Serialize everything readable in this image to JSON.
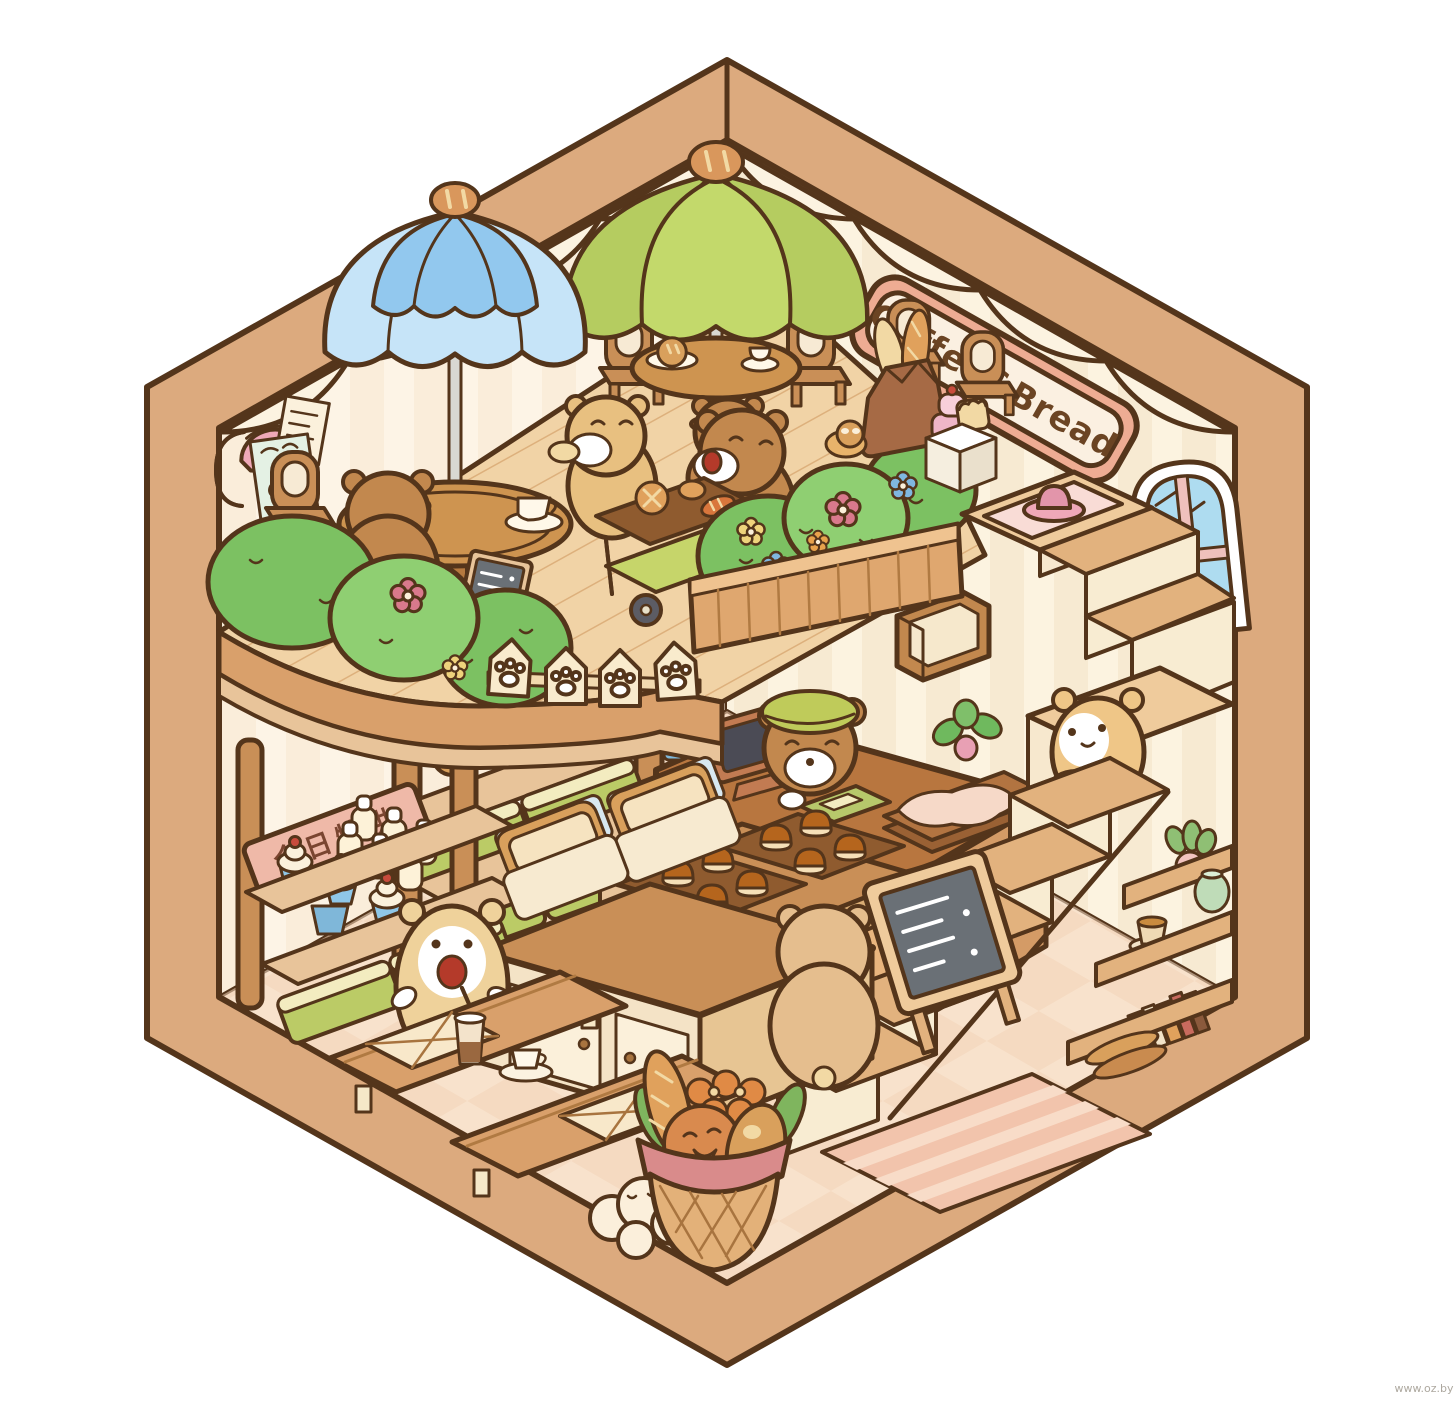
{
  "artwork": {
    "sign_coffee_bread": "Coffee&Bread",
    "sign_monthly_special": "今日特供",
    "watermark": "www.oz.by"
  },
  "palette": {
    "outline": "#54351B",
    "frame": "#DCAA7E",
    "wall": "#F8ECD6",
    "wall_left": "#FAEDDA",
    "floor": "#F8E2CC",
    "deck": "#F1D3A6",
    "wood": "#C98F57",
    "wood_dark": "#8F5B2F",
    "umbrella_blue": "#92C8EE",
    "umbrella_blue_light": "#C6E4F8",
    "umbrella_green": "#C3D96B",
    "umbrella_green_light": "#EDEFCB",
    "bush_green": "#7CC162",
    "bush_green_light": "#8FCF72",
    "bear_brown": "#C2884E",
    "bear_tan": "#E8C080",
    "bear_cream": "#EFD29B",
    "sign_pink": "#EEAC93",
    "sign_cream": "#FBF0E1",
    "board_pink": "#EFB9A8",
    "window_glass": "#AEDCF0",
    "window_pink": "#EFC0BC",
    "chalkboard": "#6A7076",
    "mouth_red": "#B43A2A"
  },
  "objects": [
    "coffee-bread-sign",
    "arched-window",
    "wall-lamp",
    "coffee-poster",
    "note-paper",
    "blue-umbrella",
    "green-umbrella",
    "cafe-tables",
    "cafe-chairs",
    "bear-eating-bread",
    "bear-back-view",
    "bear-with-cart",
    "bread-cart",
    "chalkboard-easel",
    "flower-bushes",
    "paw-fence",
    "flower-planter-box",
    "bread-bag",
    "pink-cake",
    "toast-cube",
    "mezzanine-deck",
    "staircase",
    "pink-rug-with-hat",
    "hamster-with-bread",
    "cashier-bear",
    "pos-tablet",
    "card-tray",
    "paper-trays",
    "potted-plants",
    "wall-cubby",
    "bread-racks",
    "green-bread-baskets",
    "monthly-special-sign",
    "milk-bottles",
    "cupcakes",
    "pudding-trays",
    "bread-display-boxes",
    "display-cabinet",
    "customer-bear",
    "happy-bear-with-iced-coffee",
    "benches-with-cushions",
    "coffee-cup",
    "bread-basket",
    "clouds",
    "striped-doormat",
    "corner-shelf",
    "books",
    "tea-cup",
    "jar",
    "menu-a-frame-board",
    "checkered-floor"
  ]
}
